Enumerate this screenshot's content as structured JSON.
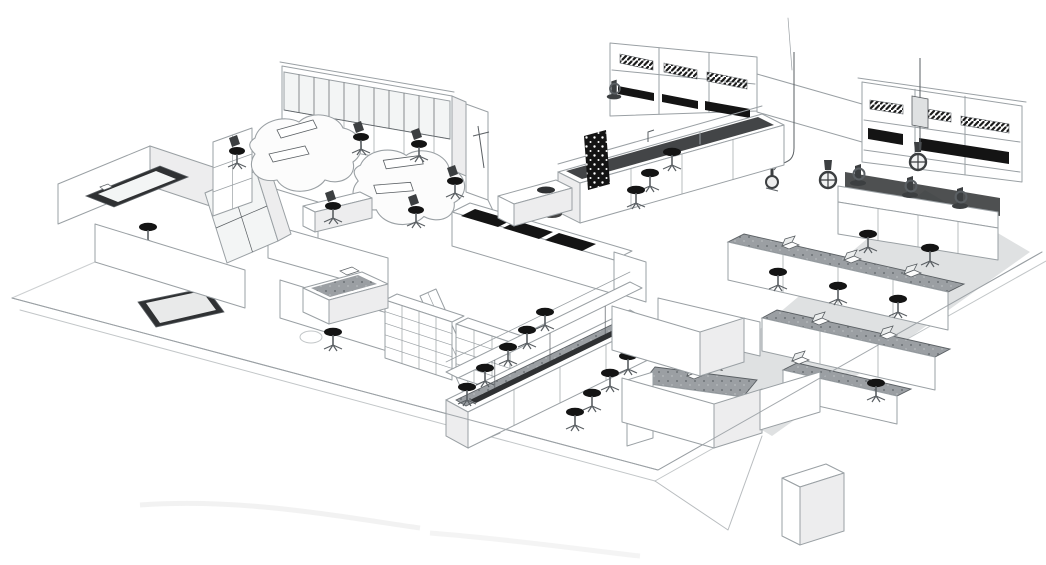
{
  "image": {
    "kind": "isometric architectural sketch",
    "subject": "Laboratory and office floor plan, 3D cutaway line drawing",
    "style": "monochrome pencil-sketch render on white background",
    "aria_label": "3D pencil-sketch floor plan of a laboratory: open office with curved desks and glass partition, fume hood banks, island lab benches with stools, shelving, instrument benches and corridor rooms"
  },
  "colors": {
    "paper": "#ffffff",
    "ink": "#9aa0a4",
    "ink-dark": "#5a5f63",
    "black": "#141414",
    "counter-dark": "#2f3133",
    "counter-mid": "#8b9094",
    "wall": "#ffffff",
    "wall-shade": "#ededee",
    "glass": "#f3f5f5",
    "floor-shade": "#d2d4d5",
    "equip": "#3c3f41"
  },
  "areas": [
    {
      "id": "office-area",
      "label": "open office with two curved team desks and office chairs"
    },
    {
      "id": "glass-partition",
      "label": "glazed partition wall with clerestory panes"
    },
    {
      "id": "storage-room-left",
      "label": "side room with dark L-shaped worktop, stool and cubby shelf"
    },
    {
      "id": "fume-hood-bank-center",
      "label": "bank of three fume hoods with hazard-striped sashes"
    },
    {
      "id": "island-bench-top",
      "label": "island lab bench with black pegboard, sink and stools"
    },
    {
      "id": "fume-hood-bank-right",
      "label": "bank of three fume hoods with hazard-striped sashes"
    },
    {
      "id": "instrument-bench-right",
      "label": "instrument bench with microscopes and service columns"
    },
    {
      "id": "bench-rows-right",
      "label": "parallel lab benches with laptops and round stools"
    },
    {
      "id": "island-bench-bottom",
      "label": "island bench with reagent shelf and stools on both sides"
    },
    {
      "id": "shelving-row",
      "label": "open shelving cabinets"
    },
    {
      "id": "writeup-desk",
      "label": "write-up desk with stool"
    },
    {
      "id": "corridor-rooms",
      "label": "partition walls, corridor and small rooms at front"
    }
  ],
  "furniture_counts": {
    "curved_desks": 2,
    "office_chairs": 6,
    "lab_stools": 16,
    "fume_hoods": 6,
    "lab_benches": 7,
    "shelving_units": 2,
    "microscopes": 3,
    "laptops": 6
  }
}
